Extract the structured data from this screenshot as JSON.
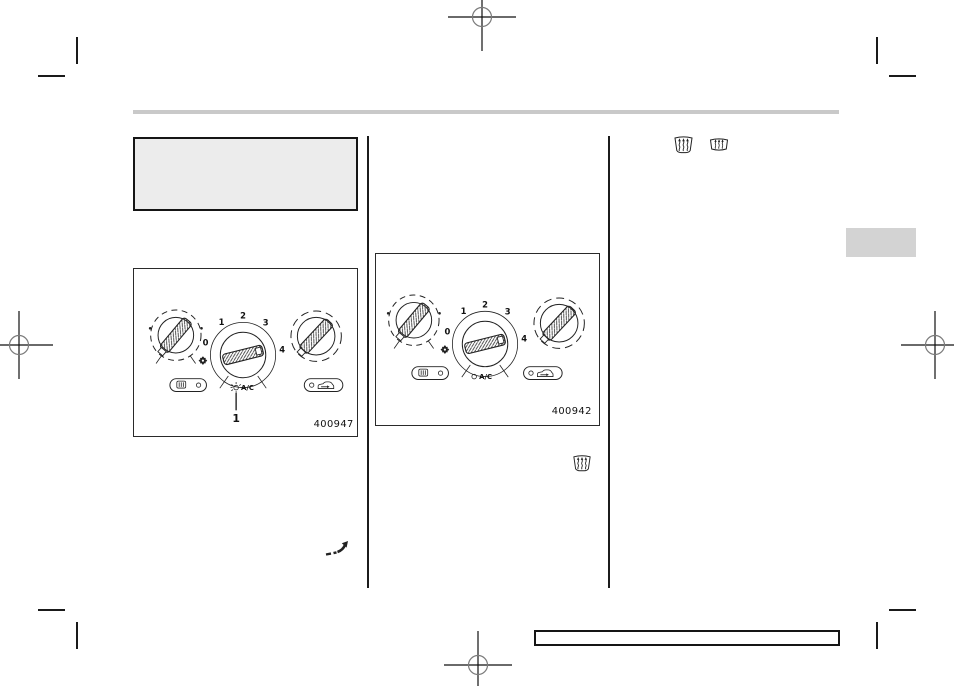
{
  "page": {
    "kind": "owner-manual-print-proof",
    "background": "#ffffff",
    "rule_color": "#c9c9c9",
    "heading_box_color": "#ececec",
    "tab_color": "#d3d3d3",
    "line_color": "#1a1a1a"
  },
  "figures": [
    {
      "code": "400947",
      "callout": "1",
      "fan_dial": {
        "labels": [
          "0",
          "1",
          "2",
          "3",
          "4"
        ],
        "ac_label": "A/C"
      }
    },
    {
      "code": "400942",
      "fan_dial": {
        "labels": [
          "0",
          "1",
          "2",
          "3",
          "4"
        ],
        "ac_label": "A/C"
      }
    }
  ],
  "icons": {
    "front_defroster": "windshield-defrost (trapezoid with rising wavy arrows)",
    "rear_defogger": "rear-window-defog (window with wavy arrows)",
    "airflow": "flow-through-ventilation arrow",
    "rear_defogger_button": "rear defogger button glyph with indicator lamp",
    "recirculation_button": "air recirculation button glyph with indicator lamp",
    "fan": "fan blade symbol",
    "registration_mark": "print registration circle-cross",
    "crop_mark": "print trim mark"
  }
}
